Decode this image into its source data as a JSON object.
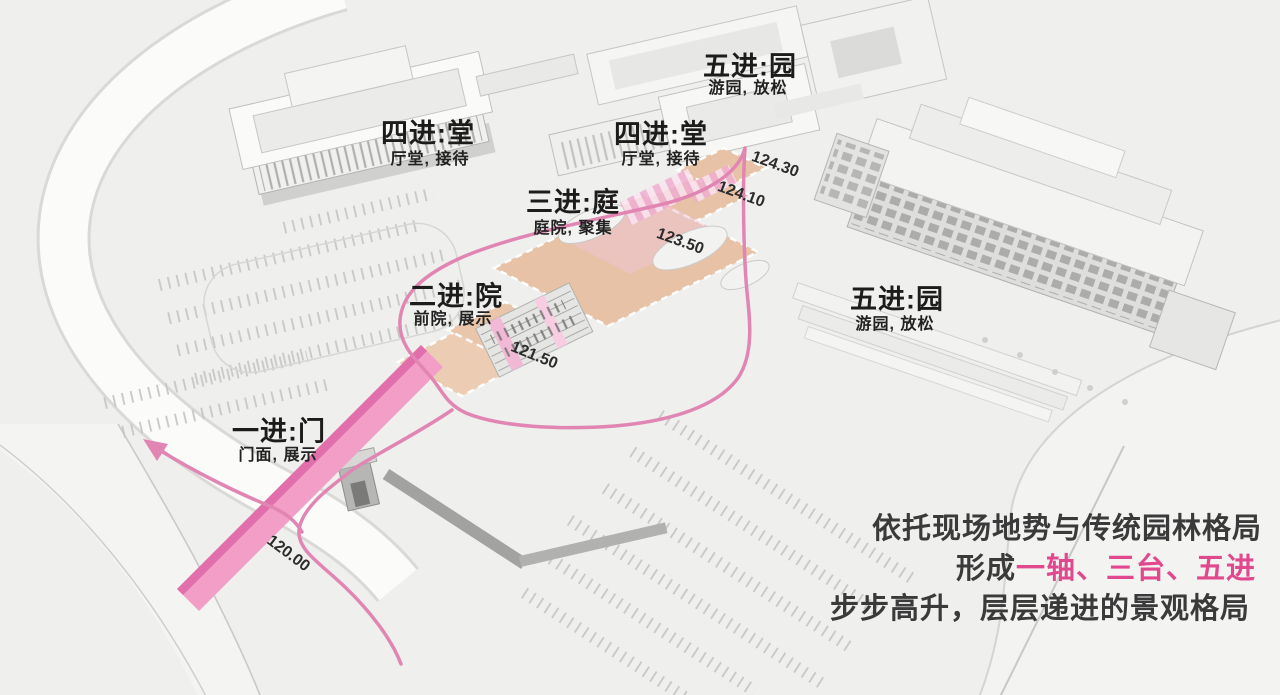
{
  "illustration": {
    "type": "axonometric-site-plan",
    "description": "masterplan diagram with pink visitor route and five courtyard stages"
  },
  "stages": [
    {
      "key": "stage-1",
      "title": "一进:门",
      "subtitle": "门面, 展示"
    },
    {
      "key": "stage-2",
      "title": "二进:院",
      "subtitle": "前院, 展示"
    },
    {
      "key": "stage-3",
      "title": "三进:庭",
      "subtitle": "庭院, 聚集"
    },
    {
      "key": "stage-4-left",
      "title": "四进:堂",
      "subtitle": "厅堂, 接待"
    },
    {
      "key": "stage-4-right",
      "title": "四进:堂",
      "subtitle": "厅堂, 接待"
    },
    {
      "key": "stage-5-top",
      "title": "五进:园",
      "subtitle": "游园, 放松"
    },
    {
      "key": "stage-5-right",
      "title": "五进:园",
      "subtitle": "游园, 放松"
    }
  ],
  "elevations": [
    "124.30",
    "124.10",
    "123.50",
    "121.50",
    "120.00"
  ],
  "caption": {
    "line1": "依托现场地势与传统园林格局",
    "line2_prefix": "形成",
    "line2_highlight": "一轴、三台、五进",
    "line3": "步步高升，层层递进的景观格局"
  },
  "colors": {
    "background": "#efefed",
    "highlight_pink": "#e1498f",
    "route_pink": "#e186b3",
    "road_band_pink": "#f29ec6",
    "road_band_stripe": "#e06fab",
    "terrace_peach": "#e8c2a6",
    "text_dark": "#3a3a3a"
  }
}
